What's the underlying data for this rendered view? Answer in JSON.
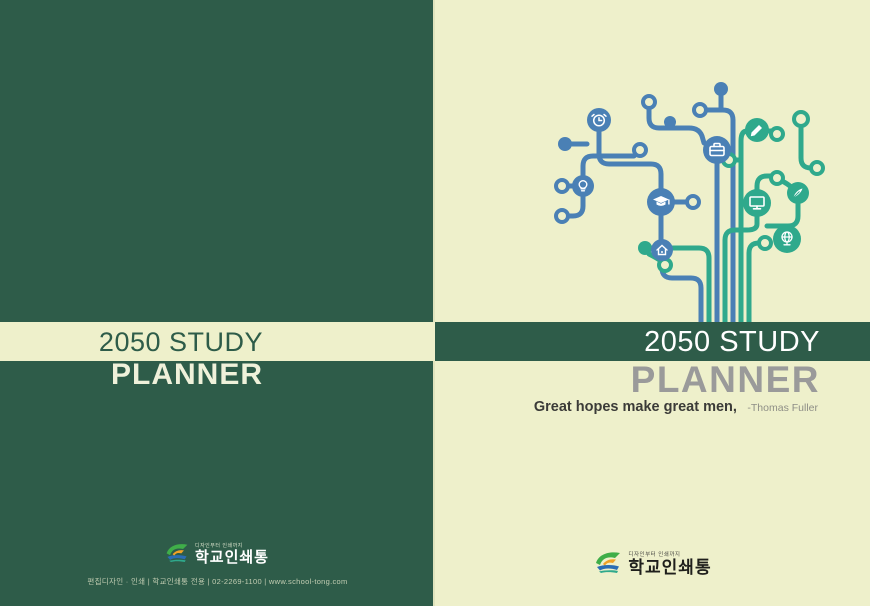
{
  "palette": {
    "dark_green": "#2e5c49",
    "cream": "#eef0cb",
    "branch_blue": "#4a80b5",
    "branch_teal": "#2fa98c",
    "planner_gray": "#9a9a9a",
    "quote_dark": "#3b3b38",
    "quote_light": "#8e8e86"
  },
  "back_cover": {
    "title_line1": "2050 STUDY",
    "title_line2": "PLANNER",
    "publisher_tagline": "디자인부터 인쇄까지",
    "publisher_name": "학교인쇄통",
    "contact_line": "편집디자인 · 인쇄 | 학교인쇄통 전용 | 02-2269-1100 | www.school-tong.com"
  },
  "front_cover": {
    "title_line1": "2050 STUDY",
    "title_line2": "PLANNER",
    "quote": "Great hopes make great men,",
    "quote_author": "-Thomas Fuller",
    "publisher_tagline": "디자인부터 인쇄까지",
    "publisher_name": "학교인쇄통"
  },
  "tree": {
    "icons": [
      "alarm-clock",
      "briefcase",
      "light-bulb",
      "graduation-cap",
      "home",
      "pencil",
      "monitor",
      "writing-hand",
      "globe"
    ]
  }
}
